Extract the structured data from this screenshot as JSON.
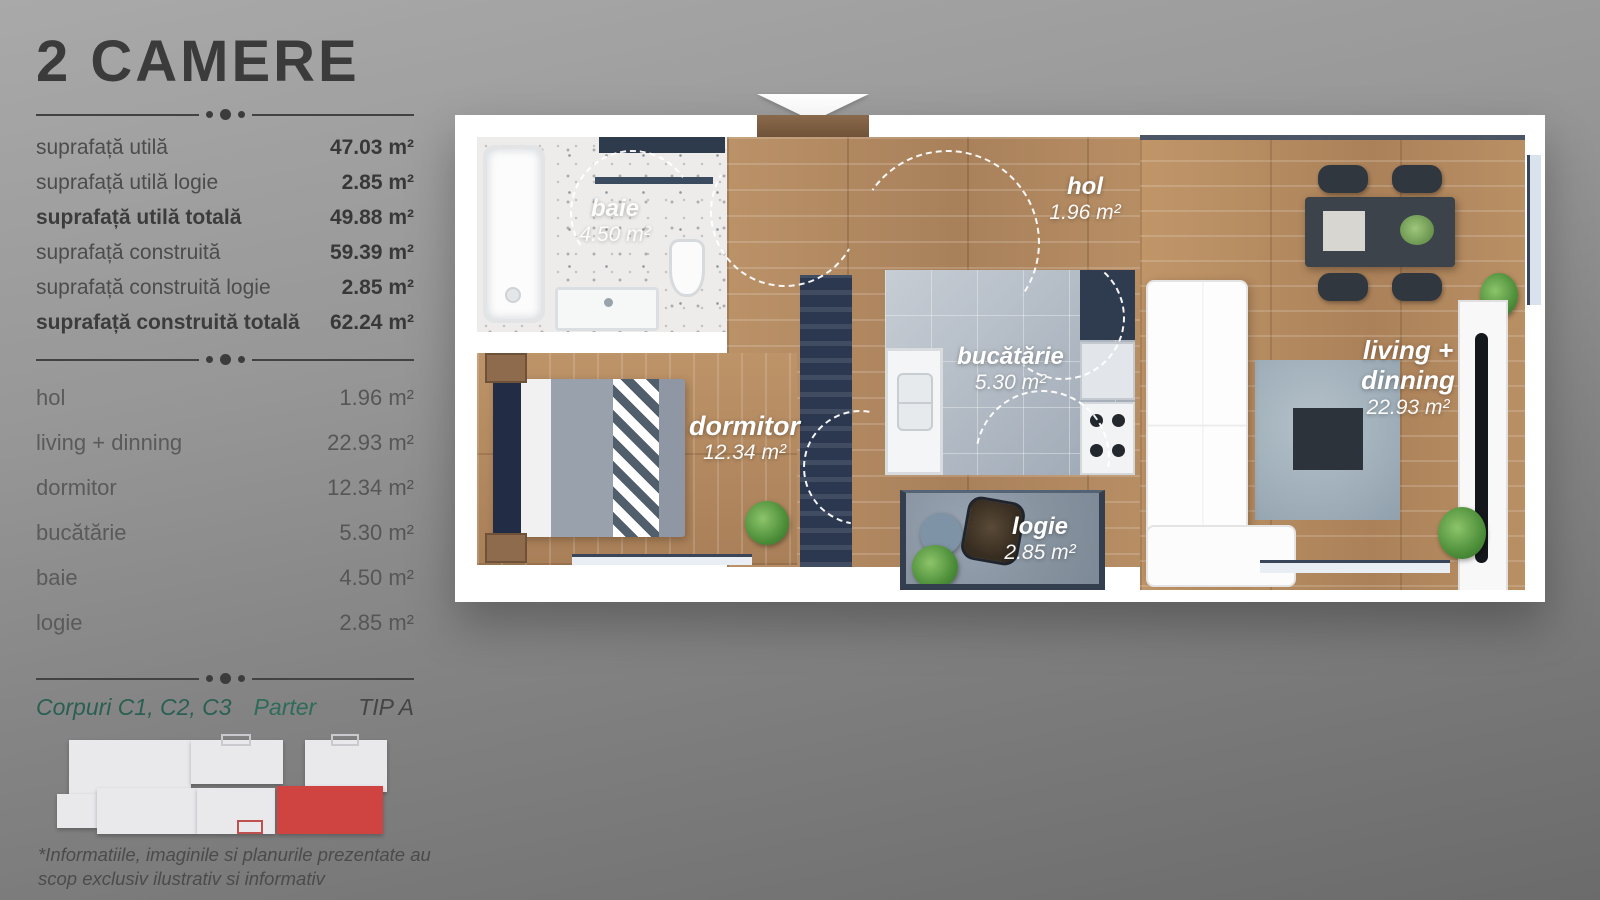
{
  "title": "2 CAMERE",
  "summary_table": {
    "rows": [
      {
        "label": "suprafață utilă",
        "value": "47.03 m²"
      },
      {
        "label": "suprafață utilă logie",
        "value": "2.85 m²"
      },
      {
        "label": "suprafață utilă totală",
        "value": "49.88 m²"
      },
      {
        "label": "suprafață construită",
        "value": "59.39 m²"
      },
      {
        "label": "suprafață construită logie",
        "value": "2.85 m²"
      },
      {
        "label": "suprafață construită totală",
        "value": "62.24 m²"
      }
    ]
  },
  "rooms_table": {
    "rows": [
      {
        "label": "hol",
        "value": "1.96 m²"
      },
      {
        "label": "living + dinning",
        "value": "22.93 m²"
      },
      {
        "label": "dormitor",
        "value": "12.34 m²"
      },
      {
        "label": "bucătărie",
        "value": "5.30 m²"
      },
      {
        "label": "baie",
        "value": "4.50 m²"
      },
      {
        "label": "logie",
        "value": "2.85 m²"
      }
    ]
  },
  "footer": {
    "corpuri": "Corpuri C1, C2, C3",
    "level": "Parter",
    "type": "TIP A",
    "disclaimer": "*Informatiile, imaginile si planurile prezentate au scop exclusiv ilustrativ si informativ"
  },
  "floorplan": {
    "labels": {
      "baie": {
        "name": "baie",
        "area": "4.50 m²"
      },
      "hol": {
        "name": "hol",
        "area": "1.96 m²"
      },
      "dormitor": {
        "name": "dormitor",
        "area": "12.34 m²"
      },
      "bucatarie": {
        "name": "bucătărie",
        "area": "5.30 m²"
      },
      "logie": {
        "name": "logie",
        "area": "2.85 m²"
      },
      "living": {
        "name_line1": "living +",
        "name_line2": "dinning",
        "area": "22.93 m²"
      }
    }
  },
  "colors": {
    "accent_red": "#cf4340",
    "teal": "#2b5f52",
    "title_gray": "#3b3b3b",
    "wood": "#b68d63",
    "kitchen_tile": "#b3bcc6",
    "logie_floor": "#8b97a5",
    "navy": "#2b3850"
  }
}
